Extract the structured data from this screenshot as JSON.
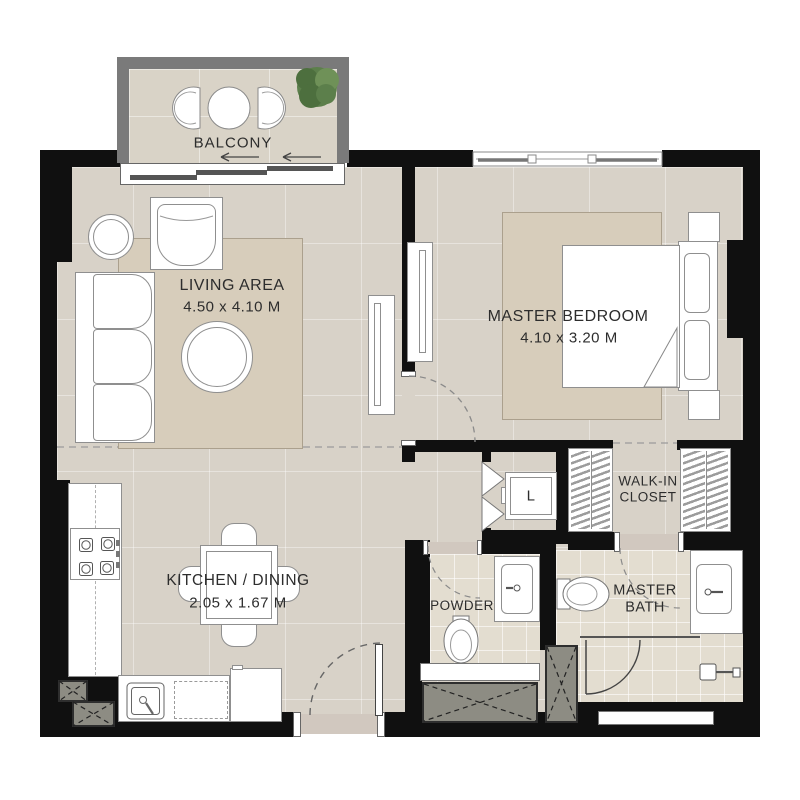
{
  "colors": {
    "wall": "#101010",
    "floor": "#d8d2c8",
    "floorBalcony": "#d9d3c7",
    "rug": "#d7cdbb",
    "tile": "#e3ddd0",
    "shaft": "#8d8c83",
    "balconyWall": "#7a7a7a",
    "threshold": "#d1c8bf",
    "text": "#2d2d2d",
    "plantDark": "#4d6f3e",
    "plantMid": "#5c7f4b",
    "plantLight": "#6f9158"
  },
  "rooms": {
    "balcony": {
      "label": "BALCONY"
    },
    "living": {
      "label": "LIVING AREA",
      "dims": "4.50 x 4.10 M"
    },
    "bedroom": {
      "label": "MASTER BEDROOM",
      "dims": "4.10 x 3.20 M"
    },
    "kitchen": {
      "label": "KITCHEN / DINING",
      "dims": "2.05 x 1.67 M"
    },
    "walkin": {
      "line1": "WALK-IN",
      "line2": "CLOSET"
    },
    "powder": {
      "label": "POWDER"
    },
    "bath": {
      "line1": "MASTER",
      "line2": "BATH"
    },
    "laundry": {
      "label": "L"
    }
  }
}
